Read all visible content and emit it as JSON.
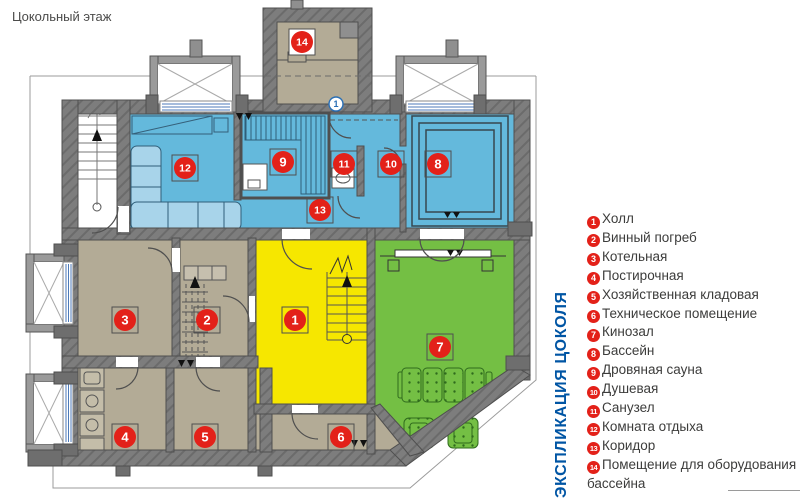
{
  "page": {
    "title": "Цокольный этаж"
  },
  "legend": {
    "title_vertical": "ЭКСПЛИКАЦИЯ ЦОКОЛЯ",
    "items": [
      {
        "num": 1,
        "label": "Холл"
      },
      {
        "num": 2,
        "label": "Винный погреб"
      },
      {
        "num": 3,
        "label": "Котельная"
      },
      {
        "num": 4,
        "label": "Постирочная"
      },
      {
        "num": 5,
        "label": "Хозяйственная кладовая"
      },
      {
        "num": 6,
        "label": "Техническое помещение"
      },
      {
        "num": 7,
        "label": "Кинозал"
      },
      {
        "num": 8,
        "label": "Бассейн"
      },
      {
        "num": 9,
        "label": "Дровяная сауна"
      },
      {
        "num": 10,
        "label": "Душевая"
      },
      {
        "num": 11,
        "label": "Санузел"
      },
      {
        "num": 12,
        "label": "Комната отдыха"
      },
      {
        "num": 13,
        "label": "Коридор"
      },
      {
        "num": 14,
        "label": "Помещение для оборудования бассейна"
      }
    ]
  },
  "plan": {
    "section_marker": "1",
    "badges": [
      {
        "num": 1,
        "x": 295,
        "y": 320
      },
      {
        "num": 2,
        "x": 207,
        "y": 320
      },
      {
        "num": 3,
        "x": 125,
        "y": 320
      },
      {
        "num": 4,
        "x": 125,
        "y": 437
      },
      {
        "num": 5,
        "x": 205,
        "y": 437
      },
      {
        "num": 6,
        "x": 341,
        "y": 437
      },
      {
        "num": 7,
        "x": 440,
        "y": 347
      },
      {
        "num": 8,
        "x": 438,
        "y": 164
      },
      {
        "num": 9,
        "x": 283,
        "y": 162
      },
      {
        "num": 10,
        "x": 391,
        "y": 164
      },
      {
        "num": 11,
        "x": 344,
        "y": 164
      },
      {
        "num": 12,
        "x": 185,
        "y": 168
      },
      {
        "num": 13,
        "x": 320,
        "y": 210
      },
      {
        "num": 14,
        "x": 302,
        "y": 42
      }
    ]
  },
  "colors": {
    "zone_blue": "#64b9dc",
    "zone_yellow": "#f6e700",
    "zone_green": "#74bf44",
    "zone_tan": "#b3ab96",
    "wall_gray": "#7d7d7d",
    "badge_red": "#e32119",
    "legend_title_blue": "#0055a4",
    "text_dark": "#3c3c3b"
  }
}
